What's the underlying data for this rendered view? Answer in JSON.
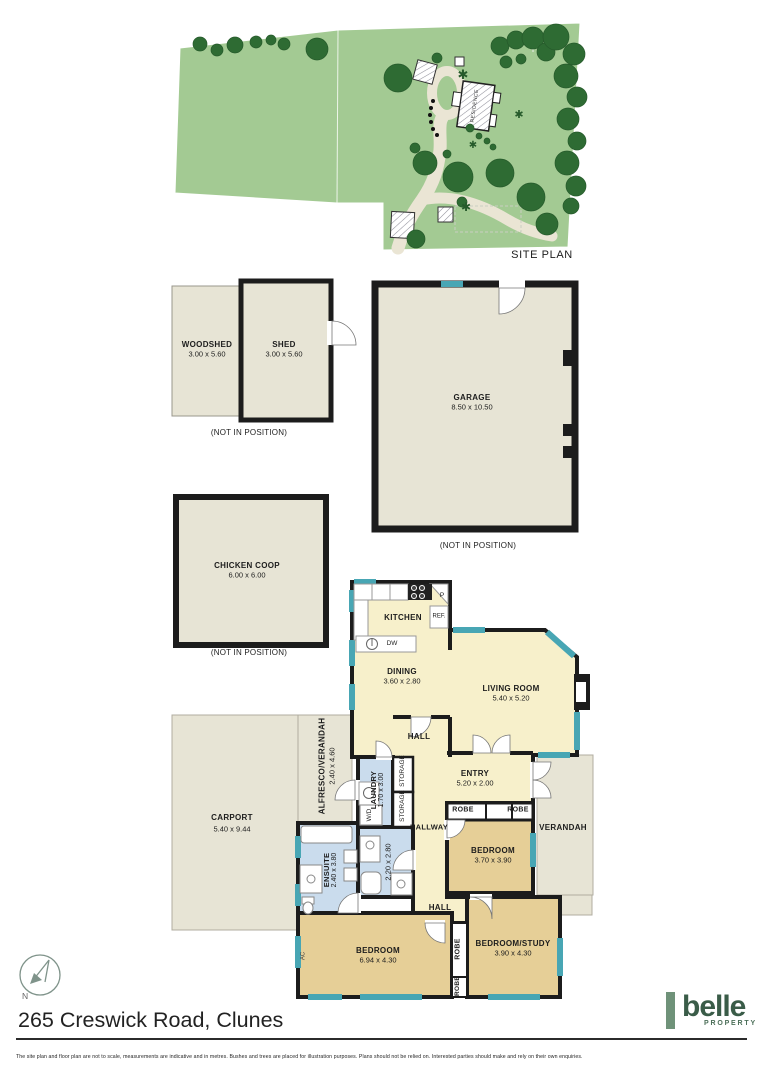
{
  "site_plan": {
    "label": "SITE PLAN",
    "residence_label": "RESIDENCE"
  },
  "outbuildings": {
    "not_in_position": "(NOT IN POSITION)",
    "woodshed": {
      "name": "WOODSHED",
      "dims": "3.00 x 5.60"
    },
    "shed": {
      "name": "SHED",
      "dims": "3.00 x 5.60"
    },
    "garage": {
      "name": "GARAGE",
      "dims": "8.50 x 10.50"
    },
    "chicken_coop": {
      "name": "CHICKEN COOP",
      "dims": "6.00 x 6.00"
    }
  },
  "rooms": {
    "kitchen": {
      "name": "KITCHEN"
    },
    "dining": {
      "name": "DINING",
      "dims": "3.60 x 2.80"
    },
    "living": {
      "name": "LIVING ROOM",
      "dims": "5.40 x 5.20"
    },
    "hall_upper": {
      "name": "HALL"
    },
    "entry": {
      "name": "ENTRY",
      "dims": "5.20 x 2.00"
    },
    "alfresco": {
      "name": "ALFRESCO/VERANDAH",
      "dims": "2.40 x 4.60"
    },
    "laundry": {
      "name": "LAUNDRY",
      "dims": "1.70 x 3.00"
    },
    "storage_a": {
      "name": "STORAGE"
    },
    "storage_b": {
      "name": "STORAGE"
    },
    "hallway": {
      "name": "HALLWAY"
    },
    "robe_a": {
      "name": "ROBE"
    },
    "robe_b": {
      "name": "ROBE"
    },
    "bedroom1": {
      "name": "BEDROOM",
      "dims": "3.70 x 3.90"
    },
    "verandah": {
      "name": "VERANDAH"
    },
    "carport": {
      "name": "CARPORT",
      "dims": "5.40 x 9.44"
    },
    "ensuite": {
      "name": "ENSUITE",
      "dims": "2.40 x 3.80"
    },
    "bathroom": {
      "dims": "2.20 x 2.80"
    },
    "hall_lower": {
      "name": "HALL"
    },
    "bedroom2": {
      "name": "BEDROOM",
      "dims": "6.94 x 4.30"
    },
    "robe_c": {
      "name": "ROBE"
    },
    "robe_d": {
      "name": "ROBE"
    },
    "study": {
      "name": "BEDROOM/STUDY",
      "dims": "3.90 x 4.30"
    }
  },
  "fixtures": {
    "pantry": "P",
    "fridge": "REF.",
    "dishwasher": "DW",
    "washer_dryer": "W/D",
    "ac": "AC"
  },
  "compass": {
    "north_label": "N"
  },
  "footer": {
    "title": "265 Creswick Road, Clunes",
    "brand_name": "belle",
    "brand_sub": "PROPERTY",
    "disclaimer": "The site plan and floor plan are not to scale, measurements are indicative and in metres. Bushes and trees are placed for illustration purposes. Plans should not be relied on. Interested parties should make and rely on their own enquiries."
  },
  "colors": {
    "wall": "#1c1c1c",
    "window_teal": "#48a6b4",
    "room_cream": "#f7f0cb",
    "room_tan": "#e6cf97",
    "room_wet": "#cadced",
    "outdoor_beige": "#e7e4d5",
    "grass_green": "#a3ca93",
    "tree_green": "#2e6b33",
    "driveway_beige": "#eae5d4",
    "brand_green": "#6f9279",
    "brand_text_green": "#3a5c48"
  }
}
